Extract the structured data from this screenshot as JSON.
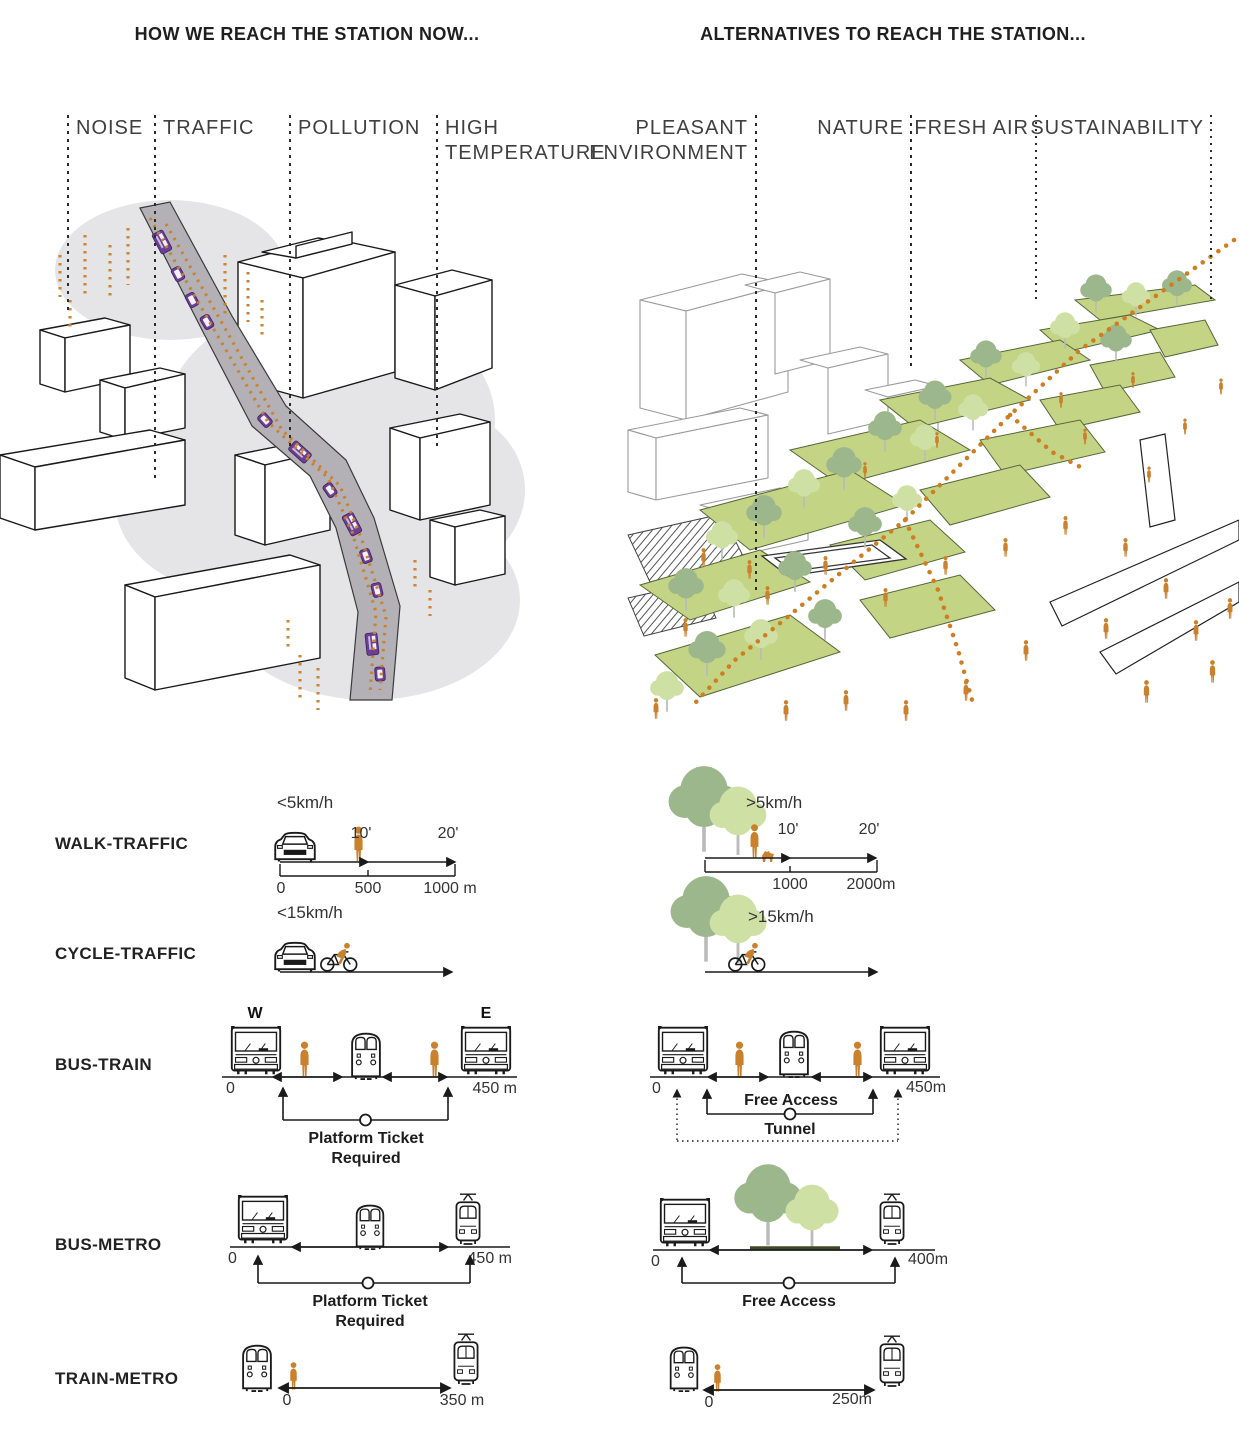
{
  "header": {
    "left_title": "HOW WE REACH THE STATION NOW...",
    "right_title": "ALTERNATIVES TO REACH THE STATION..."
  },
  "now_panel": {
    "label1": "NOISE",
    "label2": "TRAFFIC",
    "label3": "POLLUTION",
    "label4a": "HIGH",
    "label4b": "TEMPERATURE"
  },
  "alt_panel": {
    "label1a": "PLEASANT",
    "label1b": "ENVIRONMENT",
    "label2": "NATURE",
    "label3": "FRESH AIR",
    "label4": "SUSTAINABILITY"
  },
  "rows": {
    "walk": {
      "label": "WALK-TRAFFIC",
      "now": {
        "speed": "<5km/h",
        "t1": "10'",
        "t2": "20'",
        "d0": "0",
        "d1": "500",
        "d2": "1000 m"
      },
      "alt": {
        "speed": ">5km/h",
        "t1": "10'",
        "t2": "20'",
        "d0": "0",
        "d1": "1000",
        "d2": "2000m"
      }
    },
    "cycle": {
      "label": "CYCLE-TRAFFIC",
      "now": {
        "speed": "<15km/h"
      },
      "alt": {
        "speed": ">15km/h"
      }
    },
    "bus_train": {
      "label": "BUS-TRAIN",
      "now": {
        "w": "W",
        "e": "E",
        "d0": "0",
        "d1": "450 m",
        "note1": "Platform Ticket",
        "note2": "Required"
      },
      "alt": {
        "d0": "0",
        "d1": "450m",
        "note1": "Free Access",
        "note2": "Tunnel"
      }
    },
    "bus_metro": {
      "label": "BUS-METRO",
      "now": {
        "d0": "0",
        "d1": "450 m",
        "note1": "Platform Ticket",
        "note2": "Required"
      },
      "alt": {
        "d0": "0",
        "d1": "400m",
        "note1": "Free Access"
      }
    },
    "train_metro": {
      "label": "TRAIN-METRO",
      "now": {
        "d0": "0",
        "d1": "350 m"
      },
      "alt": {
        "d0": "0",
        "d1": "250m"
      }
    }
  },
  "icons": {
    "car": "car-front",
    "bus": "bus-front",
    "train": "train-front",
    "tram": "metro-tram-front",
    "person": "pedestrian",
    "cyclist": "cyclist",
    "tree": "tree"
  },
  "colors": {
    "accent_orange": "#C9812D",
    "vehicle_purple": "#6A3F95",
    "road_gray": "#B3B1B5",
    "cloud_gray": "#E5E5E7",
    "lawn_green": "#C3D484",
    "tree_green_dark": "#9CB78B",
    "tree_green_light": "#CFE0A5",
    "outline_black": "#1A1A1A"
  }
}
